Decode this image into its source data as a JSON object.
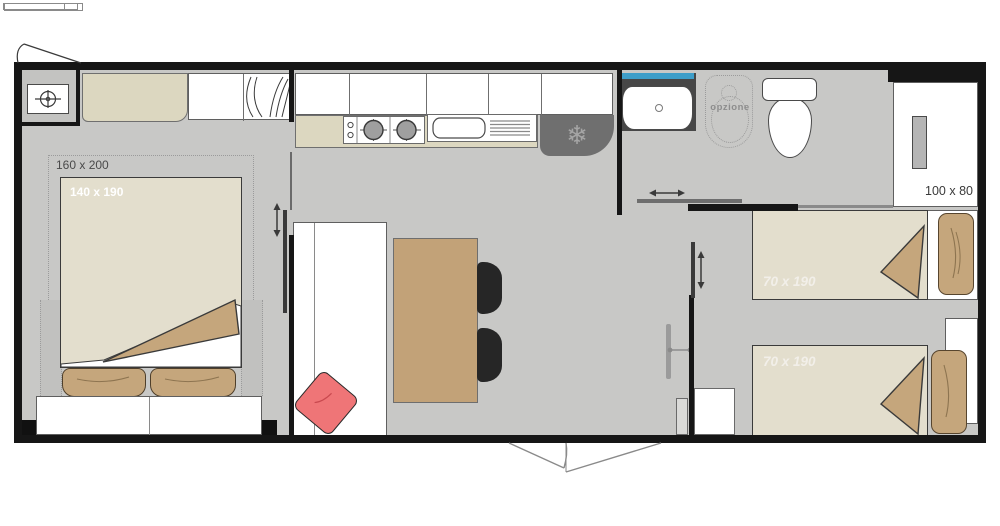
{
  "floorplan": {
    "labels": {
      "master_zone": "160 x 200",
      "master_bed": "140 x 190",
      "twin_bed_top": "70 x 190",
      "twin_bed_bottom": "70 x 190",
      "shower": "100 x 80",
      "bath_option": "opzione"
    },
    "icons": {
      "fridge_snowflake": "❄",
      "gas_heater": "crosshair-circle",
      "wardrobe": "hanging-clothes-curves",
      "hob": "two-burners",
      "sink": "basin-with-drainer",
      "arrows": "sliding-door-direction"
    },
    "colors": {
      "wall": "#161616",
      "floor": "#c8c8c6",
      "furniture_beige": "#dcd7c0",
      "mattress_beige": "#e3decd",
      "wood_tan": "#c2a278",
      "pillow_tan": "#c5a67c",
      "cushion_pink": "#ef7577",
      "fridge_gray": "#6f6f6f",
      "window_blue": "#3e9ec9",
      "chair_black": "#262626",
      "counter_dark": "#474747"
    }
  }
}
